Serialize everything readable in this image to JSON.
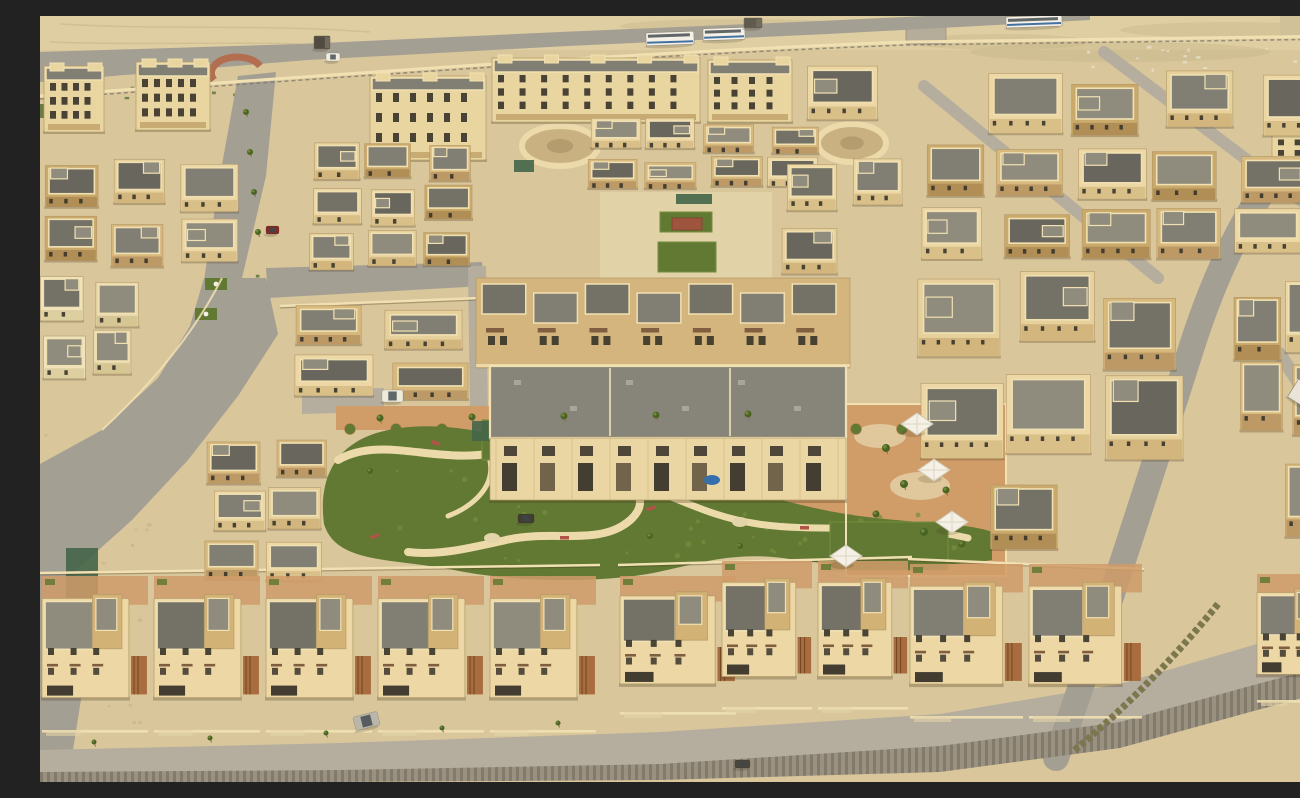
{
  "image_type": "aerial-photograph",
  "subject": "sand-colored residential housing development with central park, desert at top",
  "scene": {
    "base": {
      "w": 1300,
      "h": 766
    },
    "palette": {
      "sand": "#d8c79e",
      "sandLight": "#e3d5ac",
      "sandDark": "#c4b288",
      "road": "#a19d95",
      "roadLight": "#b3ada2",
      "redCurb": "#b06a4f",
      "parapet": "#f2e3b6",
      "cream": "#ead7a5",
      "tan": "#cfae74",
      "tanDark": "#ac8d5a",
      "roof1": "#6e6d66",
      "roof2": "#7c7b73",
      "roof3": "#8b897f",
      "window": "#2f2c27",
      "grass": "#5a752f",
      "grassLight": "#708b3b",
      "grassDark": "#42601f",
      "terra": "#cf9a68",
      "terraDark": "#b87f4f",
      "pathCream": "#ecdcae",
      "white": "#f7f4ec",
      "busBlue": "#3a6ea5",
      "rust": "#a25f33",
      "hedge": "#77734a",
      "wallGray": "#978f82",
      "wallGrayDark": "#7d766b",
      "netGreen": "#3c6148",
      "pergRed": "#9a4f3a",
      "awning": "#7b5a3f"
    },
    "desert": {
      "band": [
        0,
        0,
        1300,
        34
      ],
      "dunes": [
        [
          1080,
          36,
          150,
          10
        ],
        [
          1190,
          14,
          110,
          8
        ],
        [
          960,
          26,
          90,
          8
        ],
        [
          700,
          10,
          120,
          7
        ]
      ],
      "tracks": [
        "M20,8 C120,14 220,8 330,16",
        "M10,26 C110,30 220,24 300,30"
      ],
      "compound": [
        1240,
        0,
        58,
        22
      ],
      "gatehouse": [
        866,
        10,
        40,
        18
      ],
      "verge": [
        0,
        88,
        26,
        14
      ]
    },
    "scrub": [
      {
        "r": [
          30,
          64,
          200,
          26
        ],
        "count": 14,
        "c": "grassDark"
      },
      {
        "r": [
          0,
          380,
          110,
          180
        ],
        "count": 16,
        "c": "sandDark"
      },
      {
        "r": [
          1040,
          28,
          250,
          26
        ],
        "count": 16,
        "c": "#eae6d8"
      },
      {
        "r": [
          60,
          600,
          40,
          120
        ],
        "count": 8,
        "c": "sandDark"
      },
      {
        "r": [
          167,
          227,
          70,
          80
        ],
        "count": 8,
        "c": "grassDark"
      }
    ],
    "roads": [
      {
        "n": "top-road",
        "pts": "0,36 260,28 520,16 780,5 1012,-6 1050,-6 1050,4 788,18 528,30 268,44 0,66",
        "f": "road"
      },
      {
        "n": "entry-road",
        "pts": "198,60 236,56 226,160 202,262 164,264 180,160",
        "f": "road"
      },
      {
        "n": "branch-road",
        "pts": "226,252 442,246 444,270 228,282",
        "f": "road"
      },
      {
        "n": "left-road",
        "pts": "226,262 238,318 198,380 148,444 92,504 34,556 0,574 0,448 62,414 118,362 150,310 164,262",
        "f": "road"
      },
      {
        "n": "left-edge-road",
        "pts": "0,574 34,556 52,608 44,664 28,766 0,766",
        "f": "road"
      },
      {
        "n": "center-lane",
        "pts": "428,250 446,250 448,398 430,398",
        "f": "roadLight"
      },
      {
        "n": "park-access-lane",
        "pts": "262,374 344,372 344,396 262,398",
        "f": "roadLight"
      },
      {
        "n": "bottom-road",
        "pts": "0,734 300,727 620,716 900,698 1080,668 1210,630 1300,600 1300,652 1210,676 1080,712 900,736 620,752 300,760 0,762",
        "f": "roadLight"
      }
    ],
    "roadPaths": [
      {
        "n": "right-diagonal-road",
        "d": "M1016,742 C1062,612 1110,462 1152,330 C1190,212 1238,140 1300,92",
        "w": 26,
        "c": "road"
      },
      {
        "n": "side-street",
        "d": "M884,70 L1118,262",
        "w": 12,
        "c": "roadLight"
      },
      {
        "n": "side-street",
        "d": "M1064,36 L1300,214",
        "w": 12,
        "c": "roadLight"
      },
      {
        "n": "side-street",
        "d": "M1240,338 L1300,432",
        "w": 13,
        "c": "roadLight"
      }
    ],
    "roundabout": {
      "d": "M174,64 A24,15 0 0 1 220,50",
      "w": 7,
      "c": "redCurb"
    },
    "retainingWall": {
      "pts": "0,756 300,754 620,748 900,730 1080,706 1210,670 1300,646 1300,672 1210,696 1080,732 900,756 620,764 300,766 0,766"
    },
    "perimeterWall": {
      "d1": "M0,80 C300,58 600,36 866,26 L1300,20",
      "d2": "M0,83 C300,61 600,39 866,29 L1300,23"
    },
    "plazas": [
      {
        "n": "circular-plaza",
        "cx": 812,
        "cy": 127,
        "rx": 34,
        "ry": 19
      },
      {
        "n": "curved-terrace",
        "cx": 520,
        "cy": 130,
        "rx": 38,
        "ry": 20
      }
    ],
    "courtyards": {
      "ucBase": [
        560,
        176,
        172,
        86
      ],
      "terraStrips": [
        [
          296,
          390,
          580,
          24
        ],
        [
          448,
          484,
          382,
          22
        ]
      ],
      "umbrellaCourt": [
        806,
        388,
        160,
        172
      ],
      "sandPatches": [
        [
          840,
          420,
          26,
          12
        ],
        [
          880,
          470,
          30,
          14
        ],
        [
          850,
          530,
          24,
          10
        ]
      ],
      "scallops": [
        {
          "x1": 310,
          "x2": 866,
          "y": 413,
          "step": 46
        },
        {
          "x1": 458,
          "x2": 820,
          "y": 504,
          "step": 44
        }
      ]
    },
    "park": {
      "blob": "M284,508 C278,462 296,428 340,416 C392,402 452,416 498,430 C540,442 562,432 606,430 C648,428 664,448 652,472 C688,464 742,488 806,498 C868,508 926,506 952,516 L952,544 C898,552 820,552 756,544 C700,534 664,546 618,556 C560,568 472,566 414,554 C352,542 296,548 284,508 Z",
      "paths": [
        {
          "d": "M298,444 C340,420 390,446 448,438 C502,432 518,458 562,462 C604,466 612,492 582,510 C552,528 508,514 466,524 C430,532 398,540 368,536",
          "w": 8
        },
        {
          "d": "M562,462 C626,470 652,498 718,508 C786,518 852,504 928,522",
          "w": 7
        },
        {
          "d": "M448,438 C460,470 430,492 408,500",
          "w": 5
        }
      ],
      "ticks": [
        [
          392,
          424
        ],
        [
          470,
          434
        ],
        [
          556,
          456
        ],
        [
          606,
          492
        ],
        [
          520,
          520
        ],
        [
          760,
          510
        ],
        [
          862,
          506
        ],
        [
          330,
          520
        ]
      ],
      "pads": [
        [
          612,
          472,
          9,
          6
        ],
        [
          700,
          506,
          8,
          5
        ],
        [
          452,
          522,
          8,
          5
        ]
      ],
      "speckleSeed": 9,
      "speckleCount": 46
    },
    "lawns": [
      {
        "n": "courtyard-lawn",
        "r": [
          620,
          196,
          52,
          20
        ]
      },
      {
        "n": "courtyard-lawn",
        "r": [
          618,
          226,
          58,
          30
        ]
      },
      {
        "n": "play-lawn",
        "r": [
          442,
          404,
          46,
          40
        ]
      },
      {
        "n": "courtyard-lawn",
        "r": [
          790,
          506,
          118,
          48
        ]
      }
    ],
    "verges": [
      [
        175,
        230,
        22,
        12
      ],
      [
        165,
        262,
        22,
        12
      ],
      [
        155,
        292,
        22,
        12
      ]
    ],
    "nets": [
      [
        636,
        178,
        36,
        10
      ],
      [
        474,
        144,
        20,
        12
      ],
      [
        432,
        405,
        30,
        20
      ],
      [
        26,
        532,
        32,
        54
      ]
    ],
    "pergola": [
      632,
      202,
      30,
      12
    ],
    "walls": {
      "segs": [
        [
          0,
          557,
          560,
          549
        ],
        [
          578,
          549,
          872,
          541
        ],
        [
          868,
          543,
          1104,
          553
        ],
        [
          240,
          290,
          440,
          282
        ]
      ],
      "curve": "M182,262 C158,310 118,362 62,414",
      "courtyardRect": [
        806,
        388,
        160,
        172
      ]
    },
    "apartments": [
      {
        "n": "apartment-block",
        "x": 4,
        "y": 50,
        "w": 60,
        "h": 66,
        "floors": 3,
        "cols": 4
      },
      {
        "n": "apartment-block",
        "x": 96,
        "y": 46,
        "w": 74,
        "h": 68,
        "floors": 3,
        "cols": 5
      },
      {
        "n": "apartment-block",
        "x": 330,
        "y": 60,
        "w": 116,
        "h": 84,
        "floors": 3,
        "cols": 6
      },
      {
        "n": "apartment-block",
        "x": 452,
        "y": 42,
        "w": 208,
        "h": 64,
        "floors": 3,
        "cols": 9
      },
      {
        "n": "apartment-block",
        "x": 668,
        "y": 44,
        "w": 84,
        "h": 62,
        "floors": 3,
        "cols": 4
      },
      {
        "n": "apartment-block",
        "x": 1232,
        "y": 96,
        "w": 64,
        "h": 66,
        "floors": 4,
        "cols": 3
      }
    ],
    "upperRow": {
      "x": 436,
      "y": 262,
      "w": 374,
      "h": 90,
      "units": 7
    },
    "centralBlock": {
      "roof": [
        450,
        350,
        356,
        72
      ],
      "facade": [
        450,
        422,
        356,
        62
      ],
      "divx": [
        570,
        690
      ],
      "row1": {
        "y": 430,
        "n": 9,
        "x0": 464,
        "step": 38,
        "w": 13,
        "h": 10
      },
      "row2": {
        "y": 447,
        "n": 9,
        "x0": 462,
        "step": 38,
        "w": 15,
        "h": 28
      },
      "pool": [
        672,
        464
      ]
    },
    "clusters": [
      {
        "n": "villa-cluster",
        "x": 268,
        "y": 118,
        "w": 168,
        "h": 140,
        "cols": 3,
        "rows": 3,
        "seed": 11
      },
      {
        "n": "villa-cluster",
        "x": 0,
        "y": 142,
        "w": 200,
        "h": 114,
        "cols": 3,
        "rows": 2,
        "seed": 21
      },
      {
        "n": "villa-cluster",
        "x": 0,
        "y": 256,
        "w": 100,
        "h": 110,
        "cols": 2,
        "rows": 2,
        "seed": 31,
        "variant": "pale"
      },
      {
        "n": "villa-cluster",
        "x": 160,
        "y": 416,
        "w": 132,
        "h": 160,
        "cols": 2,
        "rows": 3,
        "seed": 41
      },
      {
        "n": "villa-cluster",
        "x": 254,
        "y": 286,
        "w": 178,
        "h": 104,
        "cols": 2,
        "rows": 2,
        "seed": 51
      },
      {
        "n": "villa-cluster",
        "x": 544,
        "y": 102,
        "w": 238,
        "h": 72,
        "cols": 4,
        "rows": 2,
        "seed": 61
      },
      {
        "n": "villa-cluster",
        "x": 736,
        "y": 142,
        "w": 132,
        "h": 118,
        "cols": 2,
        "rows": 2,
        "seed": 71
      },
      {
        "n": "villa-cluster",
        "x": 756,
        "y": 50,
        "w": 544,
        "h": 72,
        "cols": 6,
        "rows": 1,
        "seed": 81
      },
      {
        "n": "villa-cluster",
        "x": 878,
        "y": 126,
        "w": 390,
        "h": 122,
        "cols": 5,
        "rows": 2,
        "seed": 91
      },
      {
        "n": "villa-cluster",
        "x": 868,
        "y": 254,
        "w": 292,
        "h": 202,
        "cols": 3,
        "rows": 2,
        "seed": 101
      },
      {
        "n": "villa-cluster",
        "x": 1190,
        "y": 254,
        "w": 110,
        "h": 180,
        "cols": 2,
        "rows": 2,
        "seed": 111
      },
      {
        "n": "villa-cluster",
        "x": 1186,
        "y": 448,
        "w": 114,
        "h": 100,
        "cols": 2,
        "rows": 1,
        "seed": 121
      },
      {
        "n": "villa-cluster",
        "x": 950,
        "y": 462,
        "w": 152,
        "h": 92,
        "cols": 2,
        "rows": 1,
        "seed": 131
      }
    ],
    "rowClusters": [
      {
        "n": "townhouse-row",
        "x": 0,
        "y": 560,
        "w": 560,
        "h": 160,
        "cols": 5,
        "seed": 141
      },
      {
        "n": "townhouse-row",
        "x": 578,
        "y": 560,
        "w": 122,
        "h": 142,
        "cols": 1,
        "seed": 151
      },
      {
        "n": "townhouse-row",
        "x": 680,
        "y": 545,
        "w": 192,
        "h": 152,
        "cols": 2,
        "seed": 161
      },
      {
        "n": "townhouse-row",
        "x": 868,
        "y": 548,
        "w": 238,
        "h": 158,
        "cols": 2,
        "seed": 171
      },
      {
        "n": "townhouse-row",
        "x": 1215,
        "y": 558,
        "w": 85,
        "h": 132,
        "cols": 1,
        "seed": 181
      }
    ],
    "hedge": {
      "d": "M1178,588 C1120,660 1062,712 1032,736",
      "w": 7
    },
    "trees": [
      [
        340,
        402,
        3.5
      ],
      [
        432,
        401,
        3.5
      ],
      [
        524,
        400,
        3.5
      ],
      [
        616,
        399,
        3.5
      ],
      [
        708,
        398,
        3.5
      ],
      [
        846,
        432,
        4
      ],
      [
        864,
        468,
        4
      ],
      [
        884,
        516,
        4
      ],
      [
        836,
        498,
        3.5
      ],
      [
        906,
        474,
        3.5
      ],
      [
        922,
        528,
        3.5
      ],
      [
        206,
        96,
        3
      ],
      [
        210,
        136,
        3
      ],
      [
        214,
        176,
        3
      ],
      [
        218,
        216,
        3
      ],
      [
        330,
        455,
        3
      ],
      [
        700,
        530,
        3
      ],
      [
        610,
        520,
        3
      ],
      [
        54,
        726,
        2.5
      ],
      [
        170,
        722,
        2.5
      ],
      [
        286,
        717,
        2.5
      ],
      [
        402,
        712,
        2.5
      ],
      [
        518,
        707,
        2.5
      ]
    ],
    "umbrellas": [
      [
        877,
        408
      ],
      [
        894,
        454
      ],
      [
        912,
        506
      ],
      [
        806,
        540
      ]
    ],
    "vehicles": [
      {
        "n": "bus",
        "t": "bus",
        "x": 606,
        "y": 16,
        "w": 48,
        "h": 13,
        "rot": -2
      },
      {
        "n": "bus",
        "t": "bus",
        "x": 663,
        "y": 12,
        "w": 42,
        "h": 12,
        "rot": -2
      },
      {
        "n": "bus",
        "t": "bus",
        "x": 966,
        "y": 0,
        "w": 56,
        "h": 11,
        "rot": -2
      },
      {
        "n": "truck",
        "t": "truck",
        "x": 274,
        "y": 20,
        "w": 16,
        "h": 13,
        "c": "#4a463e"
      },
      {
        "n": "truck",
        "t": "truck",
        "x": 704,
        "y": 2,
        "w": 18,
        "h": 10,
        "c": "#5a564c"
      },
      {
        "n": "car",
        "t": "car",
        "x": 286,
        "y": 37,
        "w": 14,
        "h": 8,
        "c": "#f2efe6"
      },
      {
        "n": "car",
        "t": "car",
        "x": 226,
        "y": 210,
        "w": 13,
        "h": 8,
        "c": "#7a2420"
      },
      {
        "n": "van",
        "t": "car",
        "x": 342,
        "y": 374,
        "w": 21,
        "h": 12,
        "c": "#efece2"
      },
      {
        "n": "car",
        "t": "car",
        "x": 478,
        "y": 498,
        "w": 16,
        "h": 9,
        "c": "#3a372f"
      },
      {
        "n": "car",
        "t": "car",
        "x": 314,
        "y": 698,
        "w": 25,
        "h": 14,
        "c": "#b9b6ad",
        "rot": -14
      },
      {
        "n": "truck",
        "t": "truck",
        "x": 1250,
        "y": 372,
        "w": 40,
        "h": 21,
        "c": "#e9e6dc",
        "rot": 32
      },
      {
        "n": "car",
        "t": "car",
        "x": 695,
        "y": 744,
        "w": 15,
        "h": 8,
        "c": "#44413a"
      }
    ]
  }
}
